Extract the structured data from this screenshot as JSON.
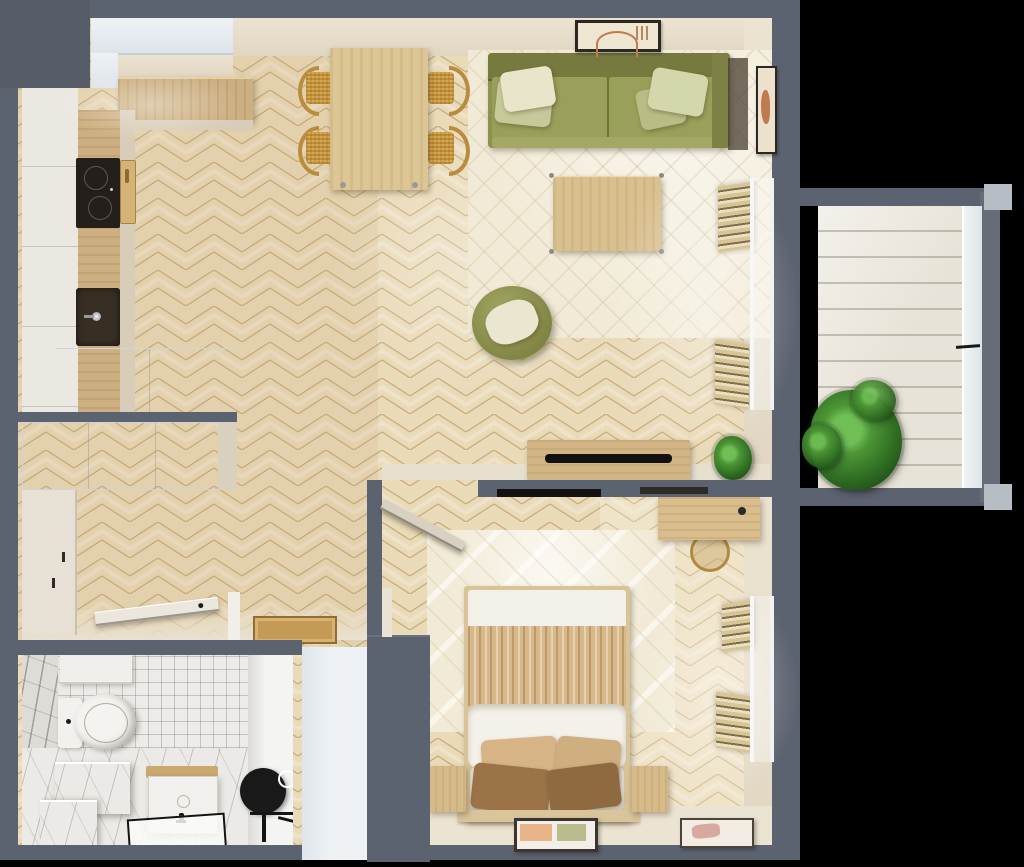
{
  "scene": {
    "type": "apartment-floor-plan-3d-render",
    "view": "top-down",
    "text_visible": "none"
  },
  "palette": {
    "background": "#000000",
    "wall": "#5c6370",
    "wall_corner": "#565d69",
    "floor_parquet": "#e9dab8",
    "parquet_joint": "#c8ab7c",
    "counter_wood": "#cdb082",
    "table_wood": "#ddc695",
    "sofa_olive": "#8e9150",
    "pillow_cream": "#e9e5ca",
    "pillow_sage": "#d3d7ab",
    "rug_cream": "#f1ead6",
    "blanket_beige": "#d8b888",
    "pillow_brown": "#9c7347",
    "duvet_white": "#f4f1ea",
    "tile_white": "#edebe7",
    "marble_white": "#eceae6",
    "cabinet_white": "#eef2f5",
    "doormat_tan": "#c49a55",
    "soundbar_black": "#121110",
    "mirror_black": "#191919",
    "plant_green": "#4d9636",
    "deck_white": "#e8e3d8",
    "rattan_gold": "#d9a94f"
  },
  "labels": {
    "sofa": "sofa",
    "dining_table": "dining-table",
    "coffee_table": "coffee-table",
    "tv_console": "tv-console",
    "bed": "bed",
    "desk": "desk",
    "toilet": "toilet",
    "vanity": "vanity",
    "mirror": "round-mirror",
    "wardrobe": "wardrobe",
    "entry_door": "entry-door",
    "doormat": "doormat",
    "balcony_plant": "potted-plant",
    "hob": "induction-hob",
    "sink": "kitchen-sink",
    "pouf": "pouf-armchair",
    "rug": "area-rug",
    "radiator": "window-blind-slats",
    "balcony": "balcony-deck"
  },
  "rooms": {
    "kitchen": {
      "name": "kitchen",
      "items": [
        "upper-cabinets",
        "tall-cabinets",
        "l-shaped-counter",
        "induction-hob",
        "cutting-board",
        "sink-with-faucet",
        "base-cabinets"
      ]
    },
    "living_dining": {
      "name": "living-dining-room",
      "items": [
        "dining-table",
        "dining-chair x4",
        "olive-sofa",
        "throw-pillow x4",
        "arch-wall-art",
        "side-wall-art",
        "cream-area-rug",
        "coffee-table",
        "olive-pouf-with-pillow",
        "window-blind-slats x2",
        "tv-console",
        "soundbar",
        "potted-plant"
      ]
    },
    "hallway": {
      "name": "hallway",
      "items": [
        "built-in-white-cabinet",
        "tall-wardrobe",
        "open-entry-door",
        "doormat"
      ]
    },
    "bathroom": {
      "name": "bathroom",
      "items": [
        "wall-hung-toilet",
        "white-shelf",
        "marble-bench",
        "marble-floor",
        "tiled-wall",
        "vanity-cabinet",
        "black-faucet",
        "shower-tray",
        "black-round-mirror",
        "shower-fixture"
      ]
    },
    "bedroom": {
      "name": "bedroom",
      "items": [
        "double-bed",
        "white-headboard",
        "beige-ruffled-blanket",
        "white-duvet",
        "pillow x4",
        "nightstand x2",
        "cream-area-rug",
        "desk",
        "brass-ring-chair",
        "window-blind-slats x2",
        "leaning-picture-frame x2",
        "wall-tv-strip",
        "open-door"
      ]
    },
    "balcony": {
      "name": "balcony",
      "items": [
        "white-plank-deck",
        "glass-railing",
        "green-plant"
      ]
    }
  },
  "counts": {
    "dining_chairs": 4,
    "sofa_pillows": 4,
    "bed_pillows": 4,
    "picture_frames_bedroom": 2,
    "wall_art_living": 2
  }
}
